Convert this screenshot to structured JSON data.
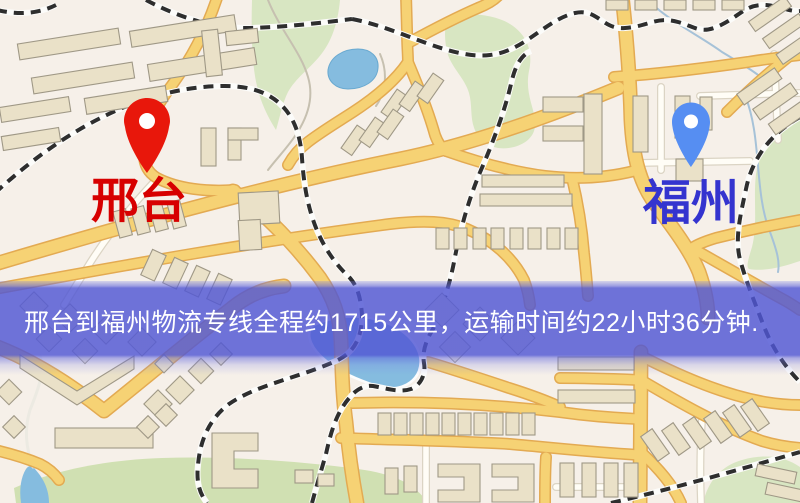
{
  "map": {
    "background_color": "#f6f0e9",
    "origin": {
      "label": "邢台",
      "pin_icon": "red-location-pin",
      "pin_color": "#e8170b",
      "label_color": "#d70000"
    },
    "destination": {
      "label": "福州",
      "pin_icon": "blue-location-pin",
      "pin_color": "#568ef2",
      "label_color": "#3434cf"
    },
    "banner": {
      "text": "邢台到福州物流专线全程约1715公里，运输时间约22小时36分钟.",
      "background_color": "#5056d4",
      "text_color": "#ffffff",
      "route": {
        "origin": "邢台",
        "destination": "福州",
        "distance_km": "1715",
        "duration": "22小时36分钟"
      }
    },
    "palette": {
      "road_major": "#f6d274",
      "road_casing": "#e3aa52",
      "road_minor": "#fffdf6",
      "building": "#eae1c8",
      "park": "#d8e6c2",
      "field": "#d0e0b2",
      "water": "#85bcdf",
      "railway": "#2e2e2e"
    }
  }
}
